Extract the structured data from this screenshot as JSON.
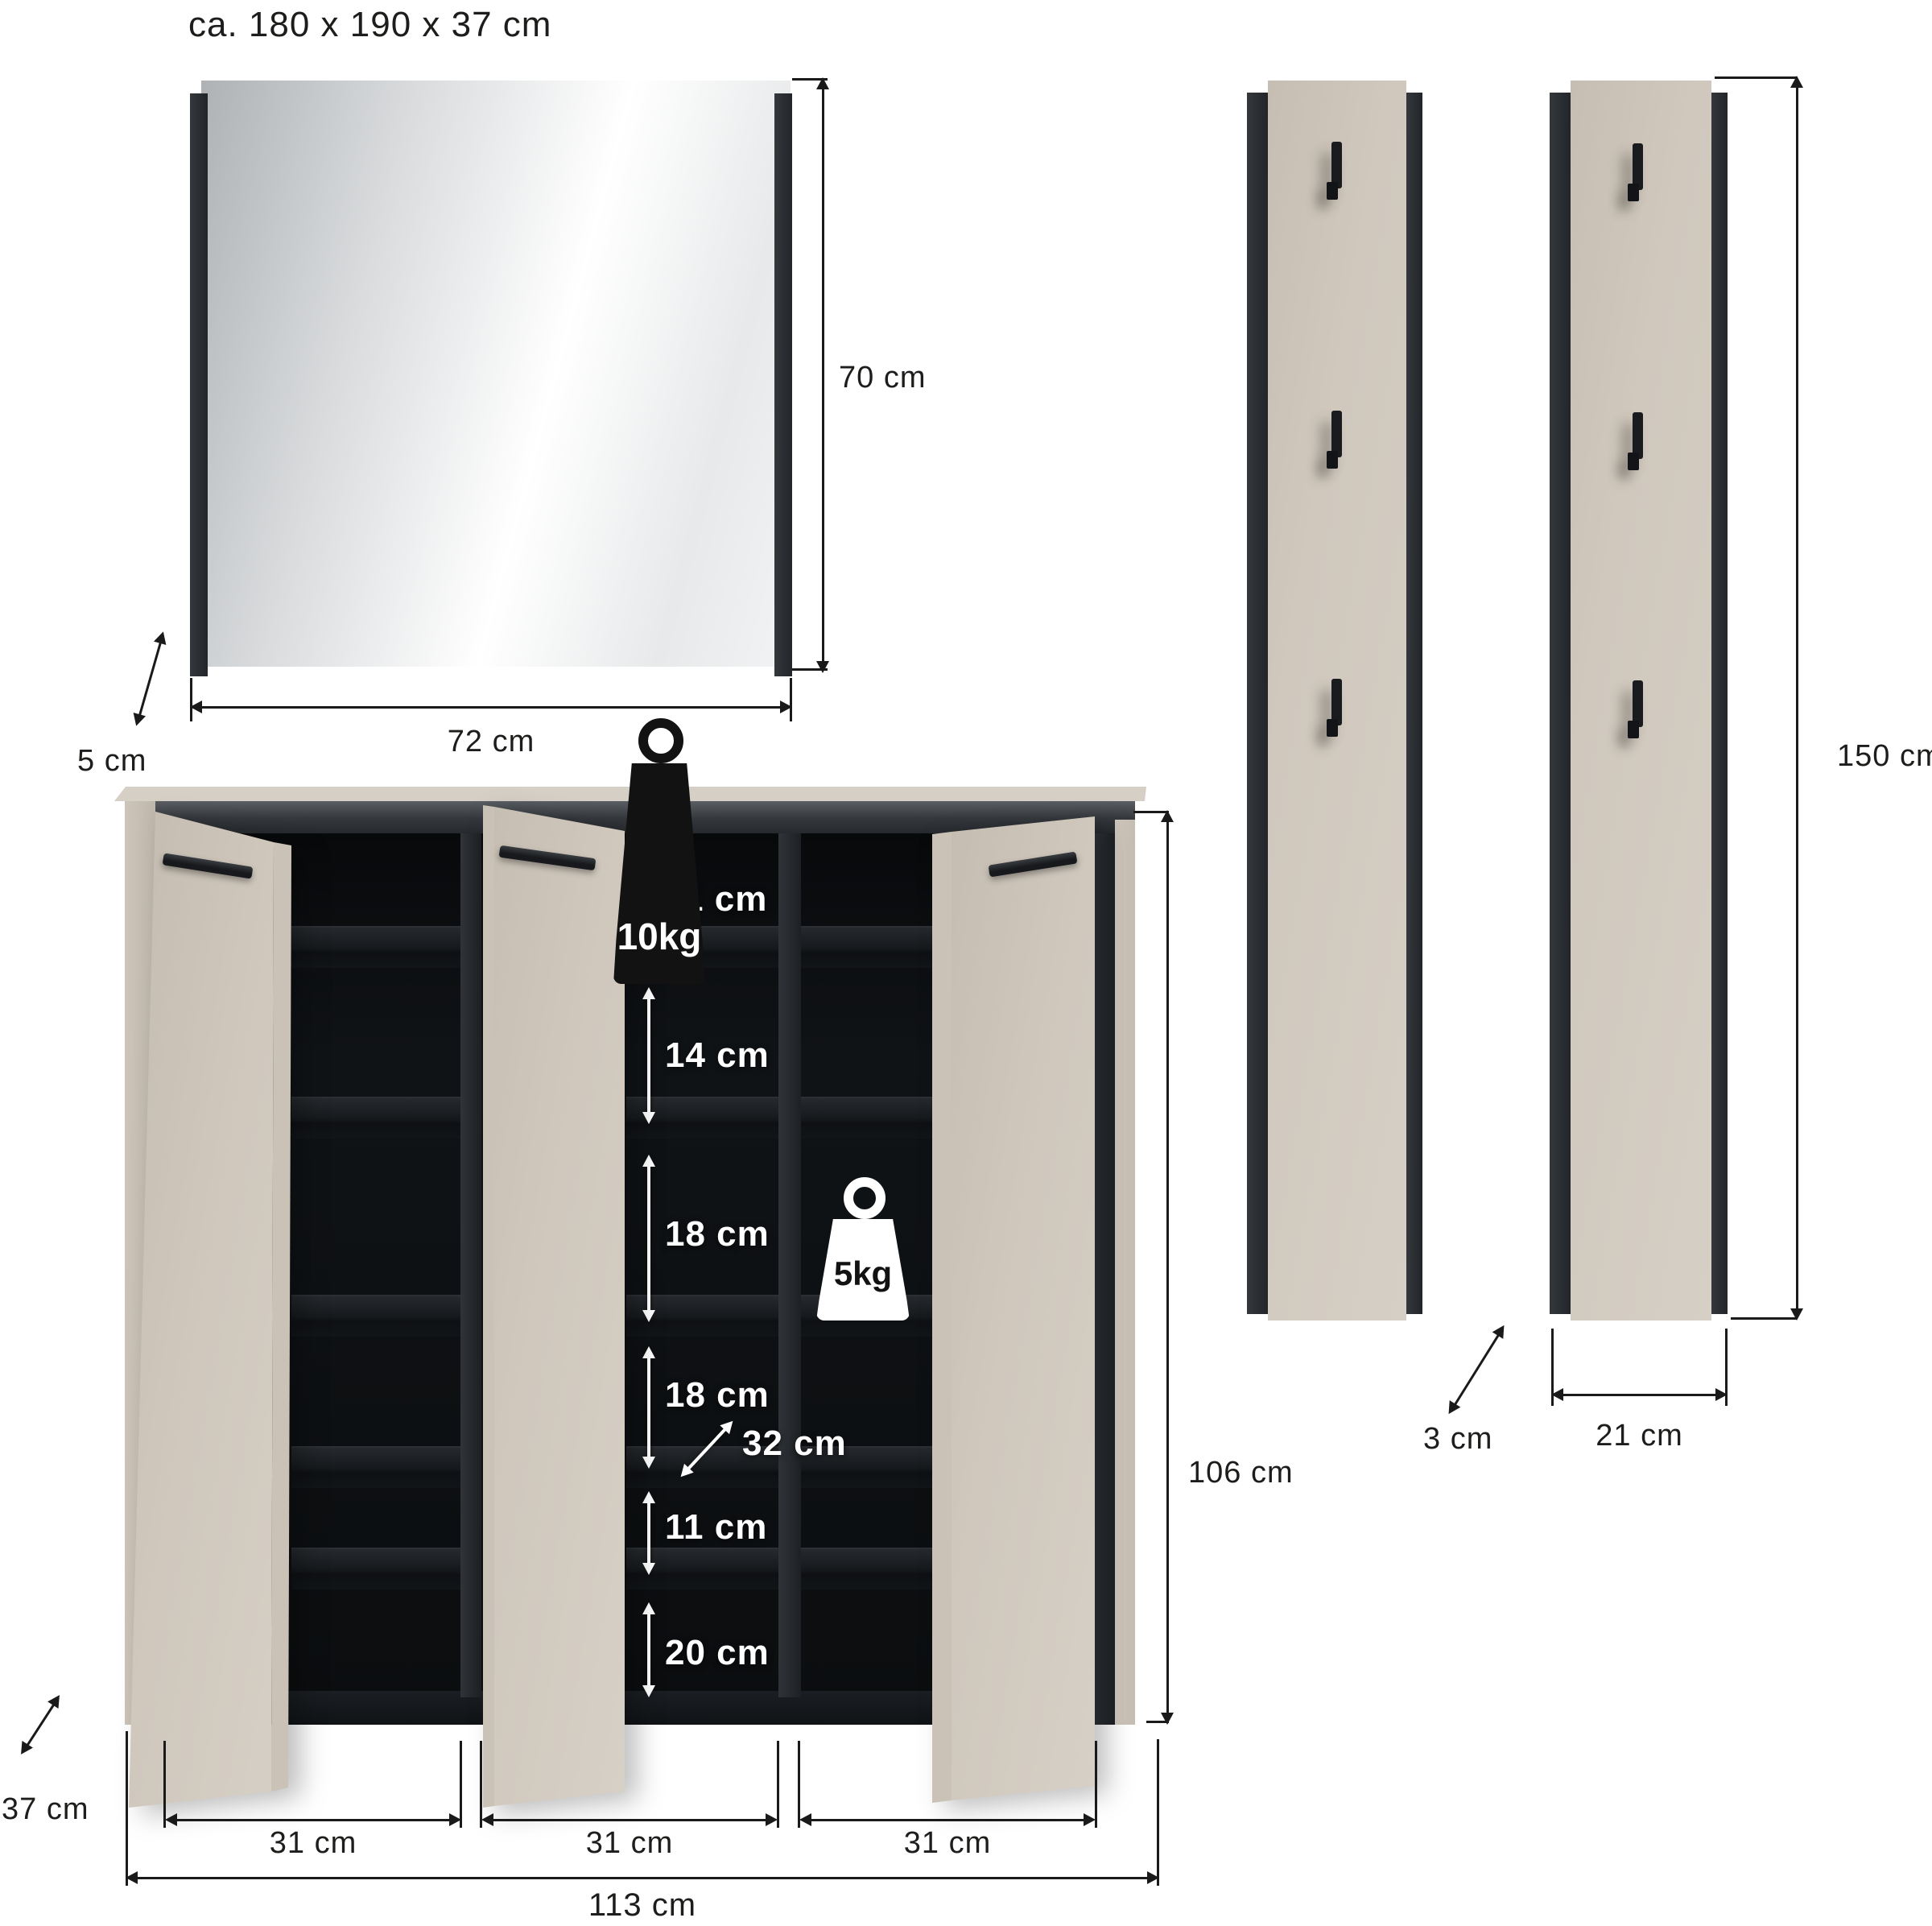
{
  "title": "ca. 180 x 190 x 37 cm",
  "mirror": {
    "height_label": "70 cm",
    "width_label": "72 cm",
    "depth_label": "5 cm"
  },
  "cabinet": {
    "top_load_label": "10kg",
    "shelf_load_label": "5kg",
    "height_label": "106 cm",
    "width_label": "113 cm",
    "depth_label": "37 cm",
    "inner_depth_label": "32 cm",
    "compartment_labels": [
      "11 cm",
      "14 cm",
      "18 cm",
      "18 cm",
      "11 cm",
      "20 cm"
    ],
    "door_width_labels": [
      "31 cm",
      "31 cm",
      "31 cm"
    ],
    "door_count": 3
  },
  "coat_racks": {
    "height_label": "150 cm",
    "width_label": "21 cm",
    "depth_label": "3 cm",
    "panel_count": 2,
    "hooks_per_panel": 3
  },
  "icons": {
    "top_load": "weight-10kg-icon",
    "shelf_load": "weight-5kg-icon",
    "hook": "coat-hook-icon"
  },
  "colors": {
    "panel_beige": "#d0c8bd",
    "frame_dark": "#2c3034",
    "interior_black": "#0c0e10",
    "dimension_line": "#1a1a1a",
    "label_white": "#ffffff",
    "background": "#ffffff"
  }
}
